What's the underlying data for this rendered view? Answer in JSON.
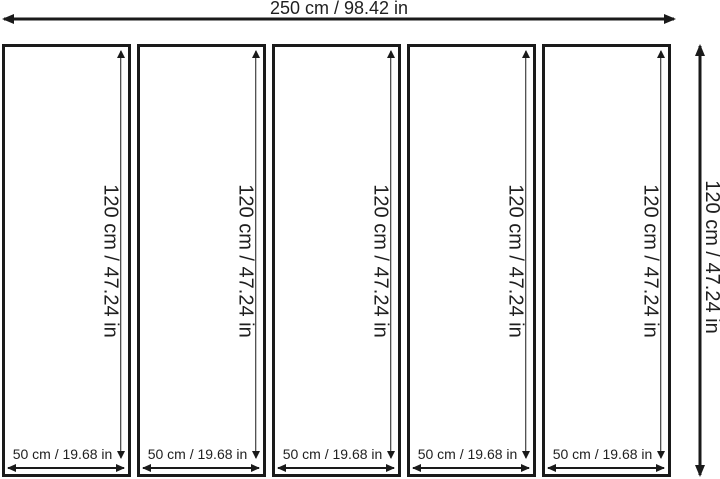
{
  "diagram": {
    "type": "panel-dimension-diagram",
    "panel_count": 5,
    "colors": {
      "line": "#1a1a1a",
      "background": "#ffffff"
    }
  },
  "labels": {
    "total_width": "250 cm / 98.42 in",
    "total_height": "120 cm / 47.24 in"
  },
  "dimensions": {
    "total_width_cm": 250,
    "total_width_in": 98.42,
    "total_height_cm": 120,
    "total_height_in": 47.24,
    "panel_width_cm": 50,
    "panel_width_in": 19.68,
    "panel_height_cm": 120,
    "panel_height_in": 47.24
  },
  "panels": [
    {
      "height_label": "120 cm / 47.24 in",
      "width_label": "50 cm / 19.68 in"
    },
    {
      "height_label": "120 cm / 47.24 in",
      "width_label": "50 cm / 19.68 in"
    },
    {
      "height_label": "120 cm / 47.24 in",
      "width_label": "50 cm / 19.68 in"
    },
    {
      "height_label": "120 cm / 47.24 in",
      "width_label": "50 cm / 19.68 in"
    },
    {
      "height_label": "120 cm / 47.24 in",
      "width_label": "50 cm / 19.68 in"
    }
  ]
}
